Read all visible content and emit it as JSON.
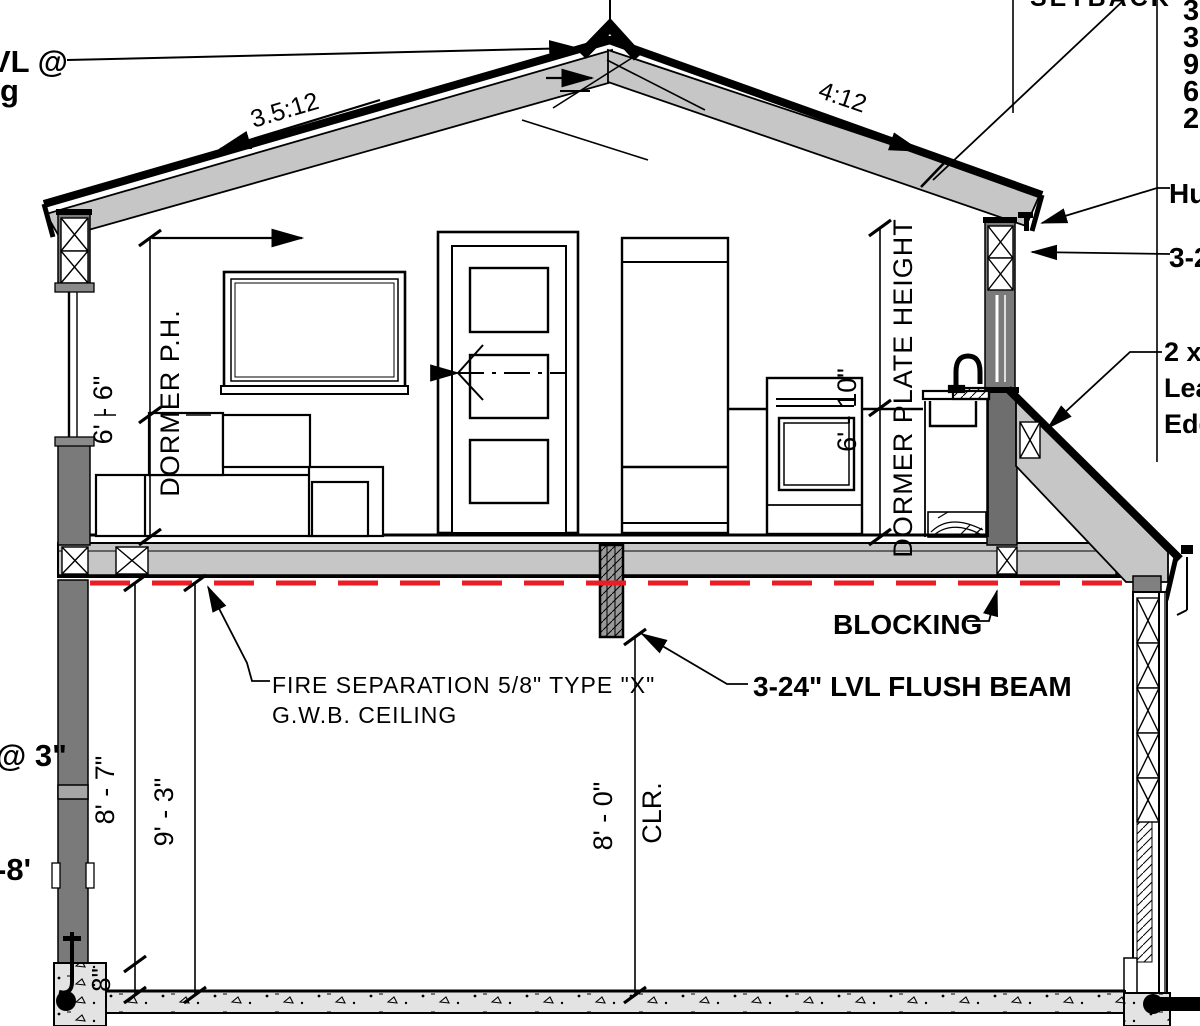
{
  "drawing": {
    "type": "residential-building-cross-section",
    "roof": {
      "left_pitch": "3.5:12",
      "right_pitch": "4:12"
    },
    "dimensions": {
      "dormer_ph_left_value": "6' - 6\"",
      "dormer_ph_left_label": "DORMER P.H.",
      "dormer_plate_right_value": "6' - 10\"",
      "dormer_plate_right_label": "DORMER PLATE HEIGHT",
      "first_floor_a": "8' - 7\"",
      "first_floor_b": "9' - 3\"",
      "clear_height_value": "8' - 0\"",
      "clear_height_suffix": "CLR.",
      "stem_wall": "8\""
    },
    "annotations": {
      "fire_separation_line1": "FIRE SEPARATION 5/8\" TYPE \"X\"",
      "fire_separation_line2": "G.W.B. CEILING",
      "flush_beam": "3-24\" LVL FLUSH BEAM",
      "blocking": "BLOCKING"
    },
    "edge_fragments": {
      "top_left_line1": "VL @",
      "top_left_line2": "g",
      "top_right": "SETBACK",
      "right_list": [
        "3",
        "3",
        "9",
        "6",
        "2"
      ],
      "right_hu": "Hu",
      "right_32": "3-2",
      "right_2x_line1": "2 x",
      "right_2x_line2": "Lea",
      "right_2x_line3": "Edg",
      "left_at3": "@ 3\"",
      "left_neg8": "-8'"
    },
    "colors": {
      "fire_separation_red": "#EC1C24",
      "rafter_gray": "#C6C6C6",
      "wall_gray": "#7A7A7A",
      "post_gray": "#6E6E6E",
      "concrete_gray": "#E3E3E3",
      "line_black": "#000000"
    }
  }
}
